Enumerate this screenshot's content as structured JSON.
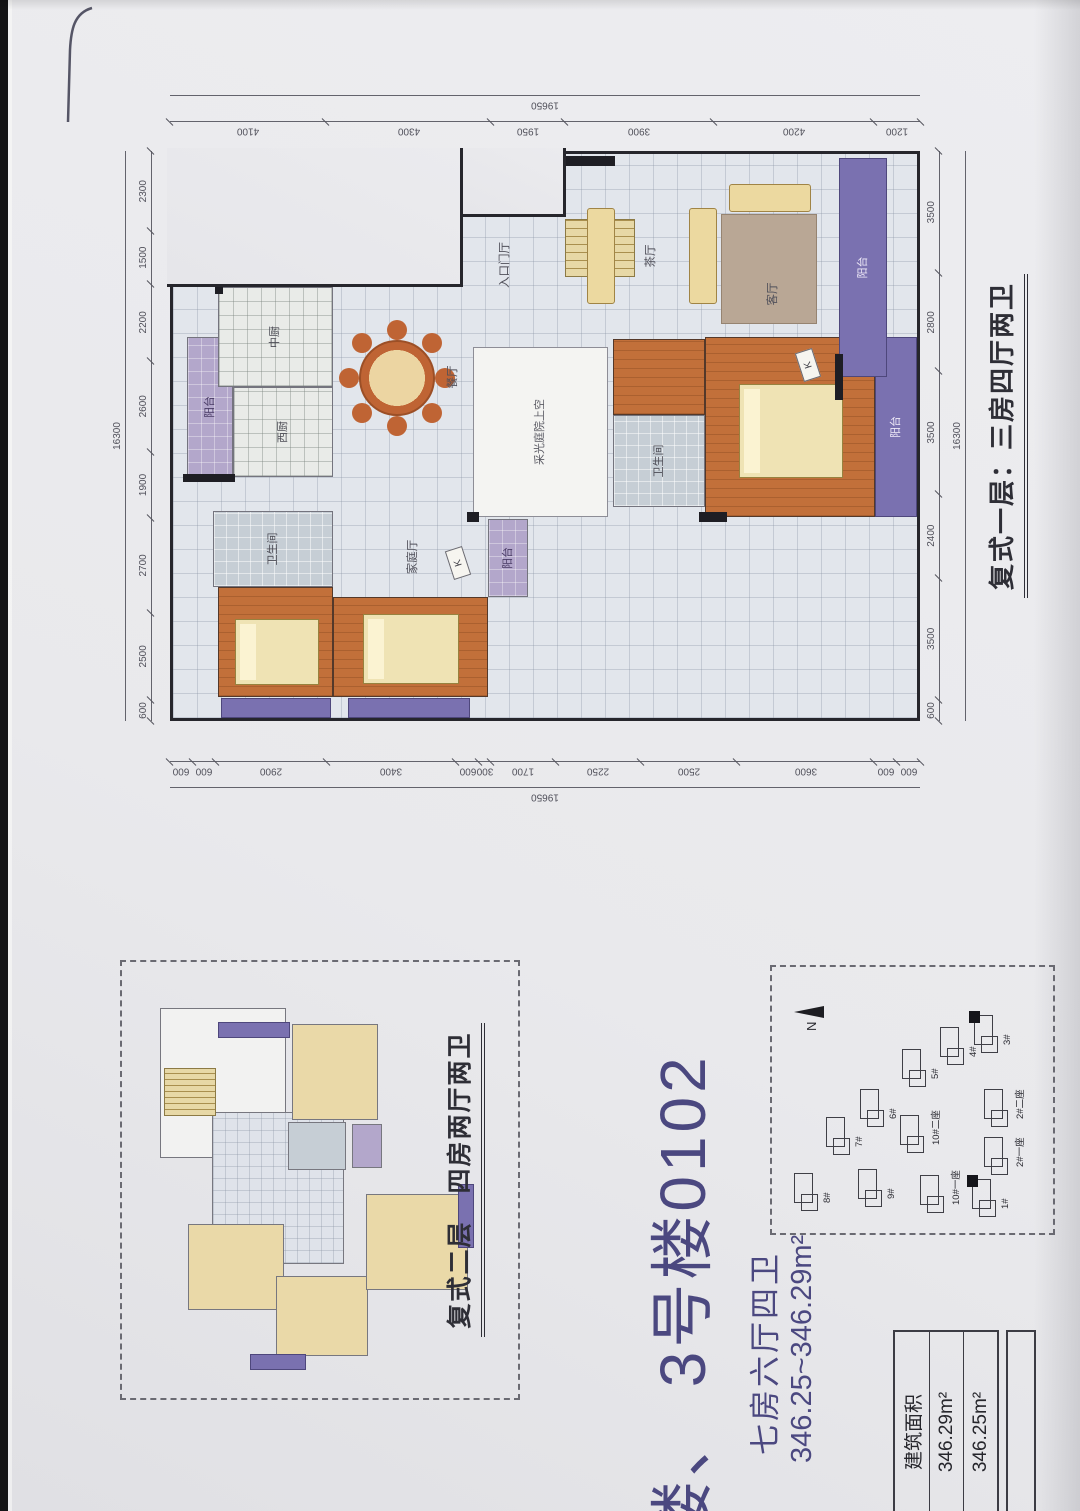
{
  "header": {
    "building_line": "楼、 3号楼0102",
    "spec": "七房六厅四卫",
    "area_range": "346.25~346.29m²"
  },
  "floor1": {
    "caption": "复式一层：三房四厅两卫",
    "dims": {
      "top": {
        "total": "16300",
        "segments": [
          "600",
          "2500",
          "2700",
          "1900",
          "2600",
          "2200",
          "1500",
          "2300"
        ]
      },
      "bottom": {
        "total": "16300",
        "segments": [
          "600",
          "3500",
          "2400",
          "3500",
          "2800",
          "3500"
        ]
      },
      "left": {
        "total": "19650",
        "segments": [
          "600",
          "600",
          "2900",
          "3400",
          "600",
          "300",
          "1700",
          "2250",
          "2500",
          "3600",
          "600",
          "600"
        ]
      },
      "right": {
        "total": "19650",
        "segments": [
          "4100",
          "4300",
          "1950",
          "3900",
          "4200",
          "1200"
        ]
      }
    },
    "rooms": [
      {
        "name": "balcony-kitchen",
        "cls": "lavender",
        "x": 241,
        "y": 14,
        "w": 140,
        "h": 46,
        "label": "阳台"
      },
      {
        "name": "kitchen-chinese",
        "cls": "ktile",
        "x": 331,
        "y": 45,
        "w": 100,
        "h": 115,
        "label": "中厨"
      },
      {
        "name": "kitchen-western",
        "cls": "ktile",
        "x": 241,
        "y": 60,
        "w": 90,
        "h": 100,
        "label": "西厨"
      },
      {
        "name": "bathroom-1",
        "cls": "bath",
        "x": 131,
        "y": 40,
        "w": 76,
        "h": 120,
        "label": "卫生间"
      },
      {
        "name": "bedroom-1",
        "cls": "wood",
        "x": 21,
        "y": 45,
        "w": 110,
        "h": 115,
        "label": "卧室"
      },
      {
        "name": "bedroom-2",
        "cls": "wood",
        "x": 21,
        "y": 160,
        "w": 100,
        "h": 155,
        "label": "卧室"
      },
      {
        "name": "balcony-side-1",
        "cls": "purple",
        "x": 0,
        "y": 48,
        "w": 20,
        "h": 110,
        "label": ""
      },
      {
        "name": "balcony-side-2",
        "cls": "purple",
        "x": 0,
        "y": 175,
        "w": 20,
        "h": 122,
        "label": ""
      },
      {
        "name": "lightwell",
        "cls": "white",
        "x": 201,
        "y": 300,
        "w": 170,
        "h": 135,
        "label": "采光庭院上空"
      },
      {
        "name": "balcony-family",
        "cls": "lavender",
        "x": 121,
        "y": 315,
        "w": 78,
        "h": 40,
        "label": "阳台"
      },
      {
        "name": "bathroom-2",
        "cls": "bath",
        "x": 211,
        "y": 440,
        "w": 92,
        "h": 92,
        "label": "卫生间"
      },
      {
        "name": "corridor",
        "cls": "wood",
        "x": 303,
        "y": 440,
        "w": 76,
        "h": 92,
        "label": ""
      },
      {
        "name": "parents-room",
        "cls": "wood",
        "x": 201,
        "y": 532,
        "w": 180,
        "h": 170,
        "label": "父母房"
      },
      {
        "name": "balcony-parents",
        "cls": "purple",
        "x": 201,
        "y": 702,
        "w": 180,
        "h": 42,
        "label": "阳台"
      },
      {
        "name": "stairs",
        "cls": "stairs",
        "x": 441,
        "y": 392,
        "w": 58,
        "h": 70,
        "label": ""
      },
      {
        "name": "balcony-living",
        "cls": "purple",
        "x": 341,
        "y": 666,
        "w": 219,
        "h": 48,
        "label": "阳台"
      },
      {
        "name": "dining-table",
        "cls": "round",
        "x": 302,
        "y": 186,
        "w": 76,
        "h": 76,
        "label": ""
      },
      {
        "name": "bed-1",
        "cls": "bed",
        "x": 33,
        "y": 62,
        "w": 66,
        "h": 84,
        "label": ""
      },
      {
        "name": "bed-2",
        "cls": "bed",
        "x": 34,
        "y": 190,
        "w": 70,
        "h": 96,
        "label": ""
      },
      {
        "name": "bed-parents",
        "cls": "bed",
        "x": 240,
        "y": 566,
        "w": 94,
        "h": 104,
        "label": ""
      },
      {
        "name": "sofa-tea-1",
        "cls": "sofa",
        "x": 414,
        "y": 414,
        "w": 96,
        "h": 28,
        "label": ""
      },
      {
        "name": "sofa-tea-2",
        "cls": "sofa",
        "x": 414,
        "y": 516,
        "w": 96,
        "h": 28,
        "label": ""
      },
      {
        "name": "rug-living",
        "cls": "rug",
        "x": 394,
        "y": 548,
        "w": 110,
        "h": 96,
        "label": ""
      },
      {
        "name": "sofa-living",
        "cls": "sofa",
        "x": 506,
        "y": 556,
        "w": 28,
        "h": 82,
        "label": ""
      },
      {
        "name": "label-dining",
        "cls": "lbl",
        "x": 296,
        "y": 272,
        "w": 90,
        "h": 16,
        "label": "餐厅"
      },
      {
        "name": "label-family",
        "cls": "lbl",
        "x": 116,
        "y": 232,
        "w": 90,
        "h": 16,
        "label": "家庭厅"
      },
      {
        "name": "label-entry",
        "cls": "lbl",
        "x": 406,
        "y": 324,
        "w": 94,
        "h": 16,
        "label": "入口门厅"
      },
      {
        "name": "label-tea",
        "cls": "lbl",
        "x": 424,
        "y": 470,
        "w": 76,
        "h": 16,
        "label": "茶厅"
      },
      {
        "name": "label-living",
        "cls": "lbl",
        "x": 386,
        "y": 592,
        "w": 76,
        "h": 16,
        "label": "客厅"
      },
      {
        "name": "k-mark-1",
        "cls": "kmark",
        "x": 338,
        "y": 626,
        "w": 30,
        "h": 18,
        "label": "K"
      },
      {
        "name": "k-mark-2",
        "cls": "kmark",
        "x": 140,
        "y": 276,
        "w": 30,
        "h": 18,
        "label": "K"
      },
      {
        "name": "wall-1",
        "cls": "wall",
        "x": 236,
        "y": 10,
        "w": 8,
        "h": 52,
        "label": ""
      },
      {
        "name": "wall-2",
        "cls": "wall",
        "x": 424,
        "y": 42,
        "w": 10,
        "h": 8,
        "label": ""
      },
      {
        "name": "wall-3",
        "cls": "wall",
        "x": 196,
        "y": 294,
        "w": 10,
        "h": 12,
        "label": ""
      },
      {
        "name": "wall-4",
        "cls": "wall",
        "x": 552,
        "y": 386,
        "w": 10,
        "h": 56,
        "label": ""
      },
      {
        "name": "wall-5",
        "cls": "wall",
        "x": 318,
        "y": 662,
        "w": 46,
        "h": 8,
        "label": ""
      },
      {
        "name": "wall-6",
        "cls": "wall",
        "x": 196,
        "y": 526,
        "w": 10,
        "h": 28,
        "label": ""
      }
    ]
  },
  "floor2": {
    "caption": "复式二层　四房两厅两卫",
    "blocks": [
      {
        "name": "terrace",
        "cls": "mwhite",
        "x": 240,
        "y": 38,
        "w": 150,
        "h": 126
      },
      {
        "name": "hall-2f",
        "cls": "mtile",
        "x": 134,
        "y": 90,
        "w": 152,
        "h": 132
      },
      {
        "name": "stairs-2f",
        "cls": "mstairs",
        "x": 282,
        "y": 42,
        "w": 48,
        "h": 52
      },
      {
        "name": "room-a",
        "cls": "mbeige",
        "x": 88,
        "y": 66,
        "w": 86,
        "h": 96
      },
      {
        "name": "room-b",
        "cls": "mbeige",
        "x": 42,
        "y": 154,
        "w": 80,
        "h": 92
      },
      {
        "name": "room-c",
        "cls": "mbeige",
        "x": 108,
        "y": 244,
        "w": 96,
        "h": 102
      },
      {
        "name": "room-d",
        "cls": "mbeige",
        "x": 278,
        "y": 170,
        "w": 96,
        "h": 86
      },
      {
        "name": "bath-2f",
        "cls": "mbath",
        "x": 228,
        "y": 166,
        "w": 48,
        "h": 58
      },
      {
        "name": "balcony-2f-1",
        "cls": "mpurple",
        "x": 28,
        "y": 128,
        "w": 16,
        "h": 56
      },
      {
        "name": "balcony-2f-2",
        "cls": "mpurple",
        "x": 360,
        "y": 96,
        "w": 16,
        "h": 72
      },
      {
        "name": "balcony-2f-3",
        "cls": "mpurple",
        "x": 150,
        "y": 336,
        "w": 64,
        "h": 16
      },
      {
        "name": "balcony-2f-4",
        "cls": "mlav",
        "x": 230,
        "y": 230,
        "w": 44,
        "h": 30
      }
    ]
  },
  "siteplan": {
    "north_label": "N",
    "buildings": [
      {
        "label": "8#",
        "x": 30,
        "y": 22,
        "hl": false
      },
      {
        "label": "7#",
        "x": 86,
        "y": 54,
        "hl": false
      },
      {
        "label": "9#",
        "x": 34,
        "y": 86,
        "hl": false
      },
      {
        "label": "6#",
        "x": 114,
        "y": 88,
        "hl": false
      },
      {
        "label": "10#二座",
        "x": 88,
        "y": 128,
        "hl": false
      },
      {
        "label": "5#",
        "x": 154,
        "y": 130,
        "hl": false
      },
      {
        "label": "10#一座",
        "x": 28,
        "y": 148,
        "hl": false
      },
      {
        "label": "4#",
        "x": 176,
        "y": 168,
        "hl": false
      },
      {
        "label": "3#",
        "x": 188,
        "y": 202,
        "hl": true
      },
      {
        "label": "1#",
        "x": 24,
        "y": 200,
        "hl": true
      },
      {
        "label": "2#一座",
        "x": 66,
        "y": 212,
        "hl": false
      },
      {
        "label": "2#二座",
        "x": 114,
        "y": 212,
        "hl": false
      }
    ]
  },
  "area_table": {
    "header": "建筑面积",
    "rows": [
      "346.29m²",
      "346.25m²"
    ]
  }
}
